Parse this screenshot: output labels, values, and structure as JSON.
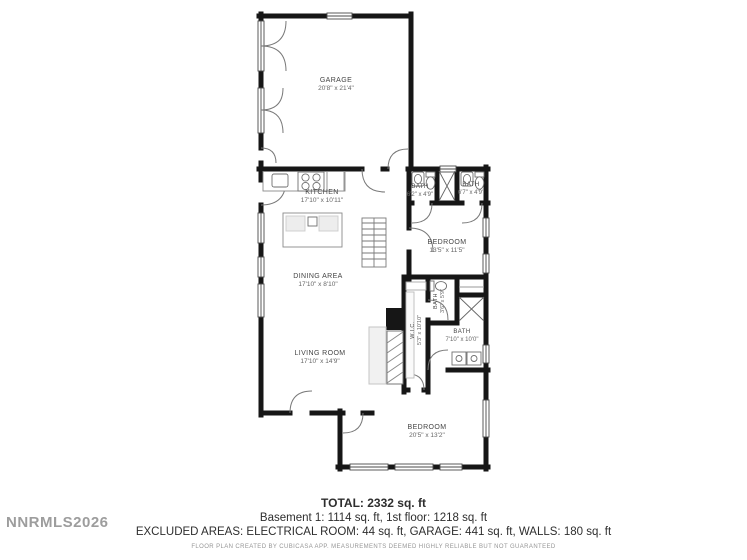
{
  "watermark": "NNRMLS2026",
  "rooms": [
    {
      "name": "GARAGE",
      "dims": "20'8\" x 21'4\""
    },
    {
      "name": "KITCHEN",
      "dims": "17'10\" x 10'11\""
    },
    {
      "name": "BATH",
      "dims": "6'2\" x 4'9\""
    },
    {
      "name": "BATH",
      "dims": "6'7\" x 4'9\""
    },
    {
      "name": "BEDROOM",
      "dims": "13'5\" x 11'5\""
    },
    {
      "name": "DINING AREA",
      "dims": "17'10\" x 8'10\""
    },
    {
      "name": "BATH",
      "dims": "3'6\" x 5'9\""
    },
    {
      "name": "W.I.C.",
      "dims": "5'3\" x 10'10\""
    },
    {
      "name": "LIVING ROOM",
      "dims": "17'10\" x 14'9\""
    },
    {
      "name": "BATH",
      "dims": "7'10\" x 10'0\""
    },
    {
      "name": "BEDROOM",
      "dims": "20'5\" x 13'2\""
    }
  ],
  "footer": {
    "total": "TOTAL: 2332 sq. ft",
    "floors": "Basement 1: 1114 sq. ft, 1st floor: 1218 sq. ft",
    "excluded": "EXCLUDED AREAS: ELECTRICAL ROOM: 44 sq. ft, GARAGE: 441 sq. ft, WALLS: 180 sq. ft",
    "disclaimer": "FLOOR PLAN CREATED BY CUBICASA APP. MEASUREMENTS DEEMED HIGHLY RELIABLE BUT NOT GUARANTEED"
  },
  "colors": {
    "wall": "#161616",
    "fixture_line": "#777777",
    "watermark": "#9d9d9d"
  }
}
